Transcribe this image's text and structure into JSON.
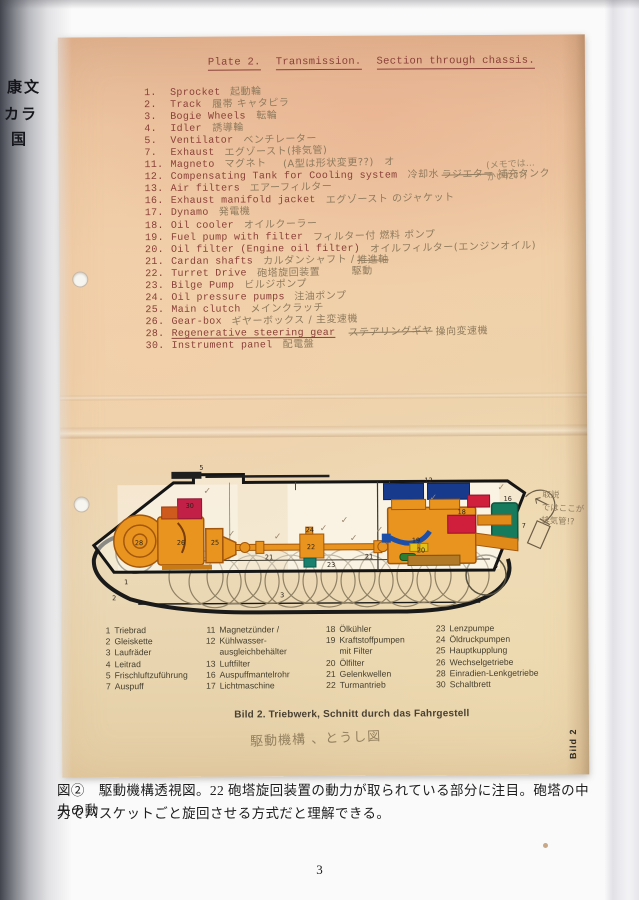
{
  "book": {
    "gutter_text": [
      "康文",
      "カラ",
      "国"
    ],
    "caption_line1": "図②　駆動機構透視図。22 砲塔旋回装置の動力が取られている部分に注目。砲塔の中央の動",
    "caption_line2": "力でバスケットごと旋回させる方式だと理解できる。",
    "page_number": "3"
  },
  "plate": {
    "header_parts": [
      "Plate 2.",
      "Transmission.",
      "Section through chassis."
    ],
    "margin_note_1": "(メモでは…",
    "margin_note_2": "かいた??)",
    "diagram_note_1": "取説",
    "diagram_note_2": "ではここが",
    "diagram_note_3": "排気管!?",
    "bild_caption": "Bild 2. Triebwerk, Schnitt durch das Fahrgestell",
    "bild_caption_hand": "駆動機構 、とうし図",
    "side_label": "Bild 2"
  },
  "parts": [
    {
      "no": "1.",
      "name": "Sprocket",
      "note": "起動輪",
      "del": "",
      "post": ""
    },
    {
      "no": "2.",
      "name": "Track",
      "note": "履帯 キャタピラ",
      "del": "",
      "post": ""
    },
    {
      "no": "3.",
      "name": "Bogie Wheels",
      "note": "転輪",
      "del": "",
      "post": ""
    },
    {
      "no": "4.",
      "name": "Idler",
      "note": "誘導輪",
      "del": "",
      "post": ""
    },
    {
      "no": "5.",
      "name": "Ventilator",
      "note": "ベンチレーター",
      "del": "",
      "post": ""
    },
    {
      "no": "7.",
      "name": "Exhaust",
      "note": "エグゾースト(排気管)",
      "del": "",
      "post": ""
    },
    {
      "no": "11.",
      "name": "Magneto",
      "note": "マグネト",
      "del": "",
      "post": "　(A型は形状変更??)　オ"
    },
    {
      "no": "12.",
      "name": "Compensating Tank for Cooling system",
      "note": "冷却水",
      "del": "ラジエター",
      "post": "補充タンク"
    },
    {
      "no": "13.",
      "name": "Air filters",
      "note": "エアーフィルター",
      "del": "",
      "post": ""
    },
    {
      "no": "16.",
      "name": "Exhaust manifold jacket",
      "note": "エグゾースト のジャケット",
      "del": "",
      "post": ""
    },
    {
      "no": "17.",
      "name": "Dynamo",
      "note": "発電機",
      "del": "",
      "post": ""
    },
    {
      "no": "18.",
      "name": "Oil cooler",
      "note": "オイルクーラー",
      "del": "",
      "post": ""
    },
    {
      "no": "19.",
      "name": "Fuel pump with filter",
      "note": "フィルター付 燃料 ポンプ",
      "del": "",
      "post": ""
    },
    {
      "no": "20.",
      "name": "Oil filter  (Engine oil filter)",
      "note": "オイルフィルター(エンジンオイル)",
      "del": "",
      "post": ""
    },
    {
      "no": "21.",
      "name": "Cardan shafts",
      "note": "カルダンシャフト /",
      "del": "推進軸",
      "post": ""
    },
    {
      "no": "22.",
      "name": "Turret Drive",
      "note": "砲塔旋回装置　　　駆動",
      "del": "",
      "post": ""
    },
    {
      "no": "23.",
      "name": "Bilge Pump",
      "note": "ビルジポンプ",
      "del": "",
      "post": ""
    },
    {
      "no": "24.",
      "name": "Oil pressure pumps",
      "note": "注油ポンプ",
      "del": "",
      "post": ""
    },
    {
      "no": "25.",
      "name": "Main clutch",
      "note": "メインクラッチ",
      "del": "",
      "post": ""
    },
    {
      "no": "26.",
      "name": "Gear-box",
      "note": "ギヤーボックス / 主変速機",
      "del": "",
      "post": ""
    },
    {
      "no": "28.",
      "name": "Regenerative steering gear",
      "note": "",
      "del": "ステアリングギヤ",
      "post": "操向変速機"
    },
    {
      "no": "30.",
      "name": "Instrument panel",
      "note": "配電盤",
      "del": "",
      "post": ""
    }
  ],
  "legend": {
    "col1": [
      {
        "no": "1",
        "text": "Triebrad"
      },
      {
        "no": "2",
        "text": "Gleiskette"
      },
      {
        "no": "3",
        "text": "Laufräder"
      },
      {
        "no": "4",
        "text": "Leitrad"
      },
      {
        "no": "5",
        "text": "Frischluftzuführung"
      },
      {
        "no": "7",
        "text": "Auspuff"
      }
    ],
    "col2": [
      {
        "no": "11",
        "text": "Magnetzünder /"
      },
      {
        "no": "12",
        "text": "Kühlwasser-"
      },
      {
        "no": "",
        "text": "ausgleichbehälter"
      },
      {
        "no": "13",
        "text": "Luftfilter"
      },
      {
        "no": "16",
        "text": "Auspuffmantelrohr"
      },
      {
        "no": "17",
        "text": "Lichtmaschine"
      }
    ],
    "col3": [
      {
        "no": "18",
        "text": "Ölkühler"
      },
      {
        "no": "19",
        "text": "Kraftstoffpumpen"
      },
      {
        "no": "",
        "text": "mit Filter"
      },
      {
        "no": "20",
        "text": "Ölfilter"
      },
      {
        "no": "21",
        "text": "Gelenkwellen"
      },
      {
        "no": "22",
        "text": "Turmantrieb"
      }
    ],
    "col4": [
      {
        "no": "23",
        "text": "Lenzpumpe"
      },
      {
        "no": "24",
        "text": "Öldruckpumpen"
      },
      {
        "no": "25",
        "text": "Hauptkupplung"
      },
      {
        "no": "26",
        "text": "Wechselgetriebe"
      },
      {
        "no": "28",
        "text": "Einradien-Lenkgetriebe"
      },
      {
        "no": "30",
        "text": "Schaltbrett"
      }
    ]
  },
  "dl": [
    "5",
    "30",
    "28",
    "26",
    "25",
    "24",
    "21",
    "22",
    "23",
    "21",
    "12",
    "18",
    "19",
    "16",
    "7",
    "4",
    "3",
    "1",
    "2",
    "20"
  ],
  "glyphs": {
    "check": "✓"
  },
  "colors": {
    "paper": "#eccfa8",
    "typewriter": "#8a4038",
    "pencil": "#8f7b5e",
    "orange": "#e8941f",
    "crimson": "#c22047",
    "navy": "#173a8c",
    "teal": "#167a5c",
    "red": "#cf1f3d",
    "yellow": "#e5c019",
    "blue_pipe": "#1d4fa8",
    "green": "#2e7d32"
  }
}
